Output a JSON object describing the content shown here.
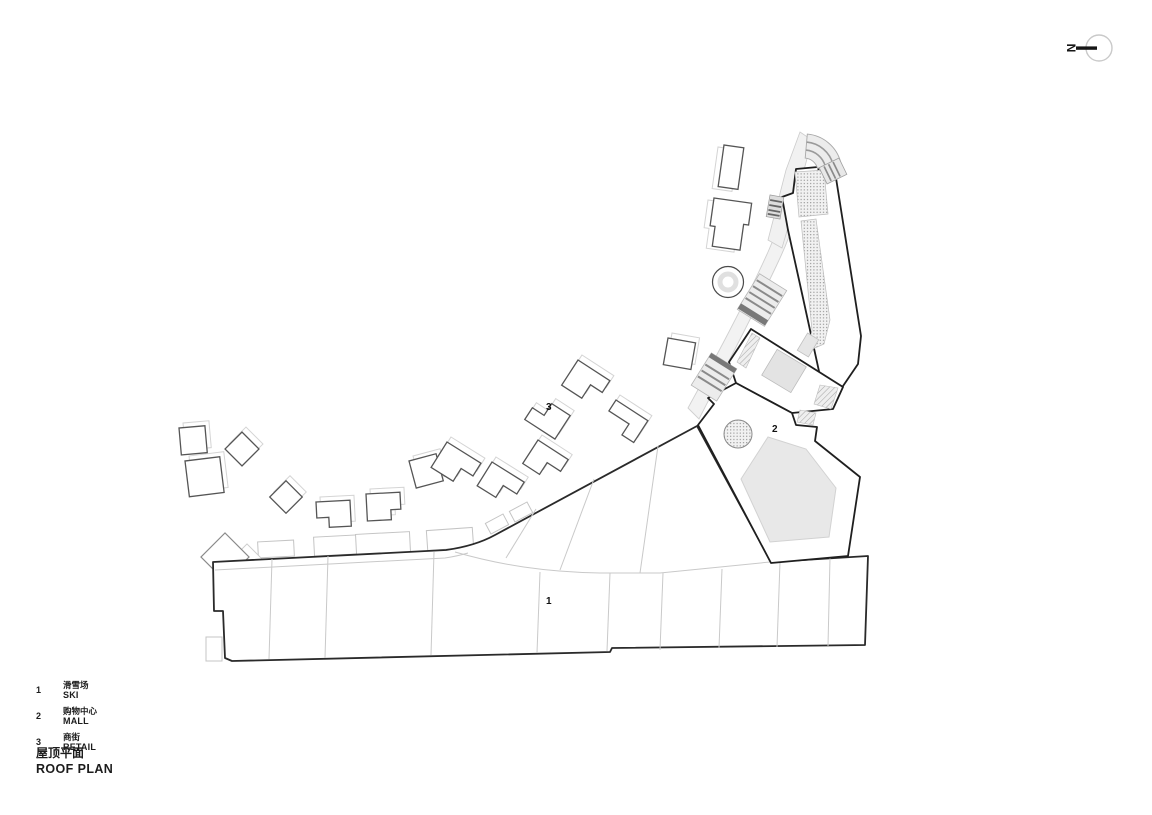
{
  "north": {
    "label": "N"
  },
  "plan_labels": {
    "ski": "1",
    "mall": "2",
    "retail": "3"
  },
  "legend": {
    "items": [
      {
        "num": "1",
        "zh": "滑雪场",
        "en": "SKI"
      },
      {
        "num": "2",
        "zh": "购物中心",
        "en": "MALL"
      },
      {
        "num": "3",
        "zh": "商街",
        "en": "RETAIL"
      }
    ]
  },
  "title": {
    "zh": "屋顶平面",
    "en": "ROOF PLAN"
  },
  "colors": {
    "ink": "#1f1f1f",
    "building_outline": "#555555",
    "light_line": "#c9c9c9",
    "fill_gray": "#e7e7e7",
    "fill_light": "#f2f2f2",
    "hatch_dot": "#8f8f8f"
  }
}
